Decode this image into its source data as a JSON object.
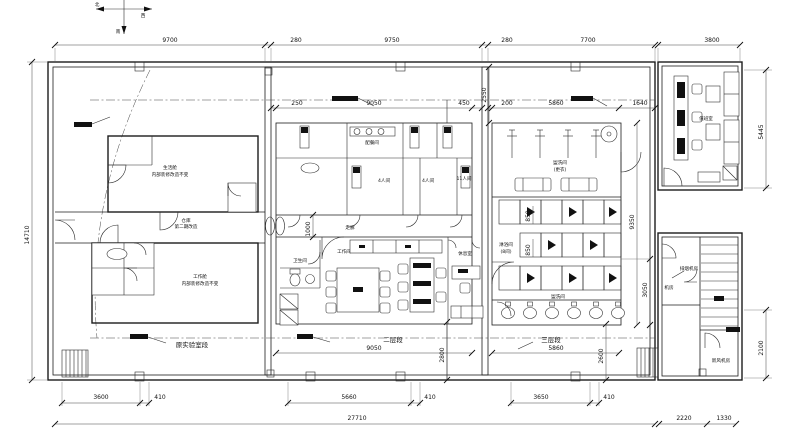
{
  "drawing": {
    "compass": {
      "north": "北",
      "west": "西",
      "south": "南"
    },
    "dims": {
      "top": [
        "9700",
        "280",
        "9750",
        "280",
        "7700",
        "3800"
      ],
      "left": "14710",
      "right_v": [
        "5445",
        "2100"
      ],
      "mid_top": [
        "250",
        "9050",
        "450"
      ],
      "sec3_top": [
        "200",
        "5860",
        "1640"
      ],
      "v2550": "2550",
      "v1000": "1000",
      "v9350": "9350",
      "v3050": "3050",
      "v850a": "850",
      "v850b": "850",
      "v2800": "2800",
      "v2600": "2600",
      "mid_bottom": "9050",
      "sec3_bottom": "5860",
      "bottom_row1": [
        "3600",
        "410",
        "5660",
        "410",
        "3650",
        "410"
      ],
      "bottom_total": "27710",
      "bottom_right": [
        "2220",
        "1330"
      ]
    },
    "sections": {
      "lab": "原实验室段",
      "two_story": "二层段",
      "three_story": "三层段"
    },
    "rooms": {
      "life_module": "生活舱",
      "life_module_note": "内部装修改造不变",
      "work_module": "工作舱",
      "work_module_note": "内部装修改造不变",
      "store": "仓库",
      "store_note": "第二期改造",
      "corridor": "走廊",
      "pantry": "配餐间",
      "room_4a": "4人间",
      "room_4b": "4人间",
      "room_11": "11人间",
      "workroom": "工作间",
      "wc": "卫生间",
      "lounge": "休息室",
      "wash_dress": "盥洗间",
      "wash_dress_note": "(更衣)",
      "shower": "淋浴间",
      "shower_note": "(8间)",
      "wash": "盥洗间",
      "duty": "值班室",
      "smoke_fan": "排烟机房",
      "fan_room": "机房",
      "fresh_air": "新风机房"
    }
  }
}
